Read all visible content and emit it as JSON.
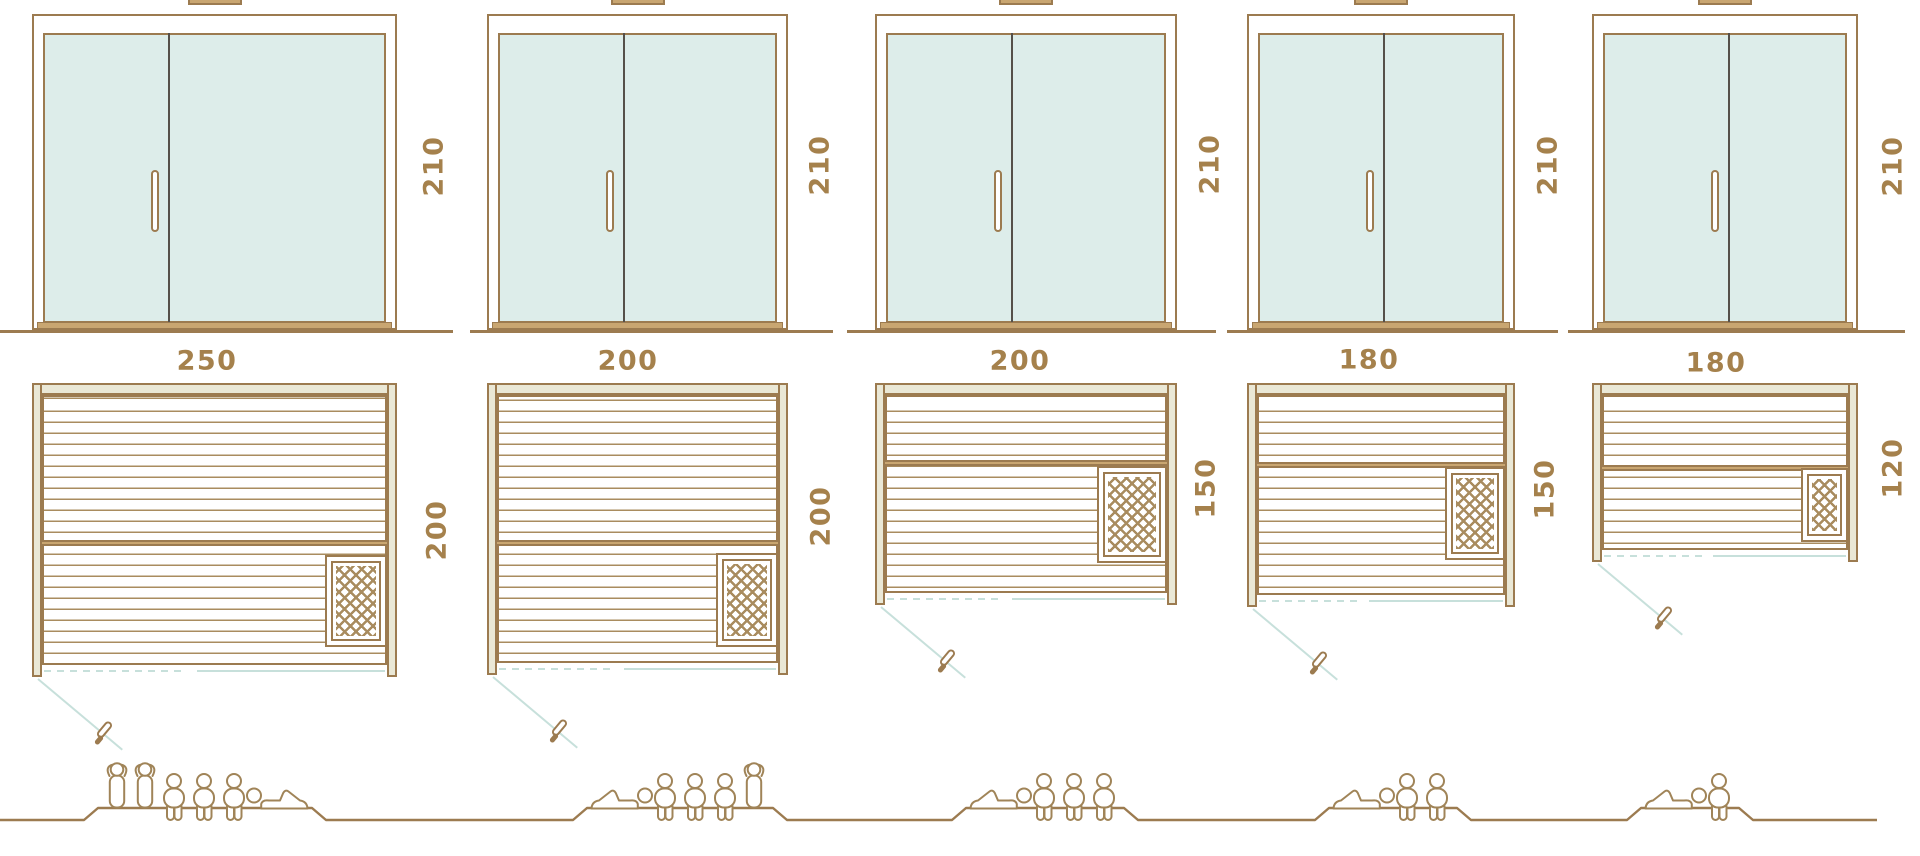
{
  "diagram_title": "sauna-cabin-size-comparison",
  "palette": {
    "background": "#ffffff",
    "outline_brown": "#9c7b50",
    "hatch_brown": "#a98c5f",
    "label_brown": "#a5814c",
    "glass_fill": "#ddedea",
    "wall_fill": "#eae8d6",
    "wood_tan": "#c9a671",
    "divider_dark": "#55504a",
    "swing_cyan": "#c7e0db",
    "figure_brown": "#a08458"
  },
  "units": [
    {
      "id": "sauna-250x200",
      "door": {
        "width_label": "250",
        "height_label": "210"
      },
      "plan": {
        "depth_label": "200"
      },
      "dimensions_cm": {
        "width": 250,
        "depth": 200,
        "height": 210
      },
      "capacity": {
        "total": 6,
        "figures": [
          "standing",
          "standing",
          "sitting",
          "sitting",
          "sitting",
          "lying-mirrored"
        ]
      }
    },
    {
      "id": "sauna-200x200",
      "door": {
        "width_label": "200",
        "height_label": "210"
      },
      "plan": {
        "depth_label": "200"
      },
      "dimensions_cm": {
        "width": 200,
        "depth": 200,
        "height": 210
      },
      "capacity": {
        "total": 5,
        "figures": [
          "lying",
          "sitting",
          "sitting",
          "sitting",
          "standing"
        ]
      }
    },
    {
      "id": "sauna-200x150",
      "door": {
        "width_label": "200",
        "height_label": "210"
      },
      "plan": {
        "depth_label": "150"
      },
      "dimensions_cm": {
        "width": 200,
        "depth": 150,
        "height": 210
      },
      "capacity": {
        "total": 4,
        "figures": [
          "lying",
          "sitting",
          "sitting",
          "sitting"
        ]
      }
    },
    {
      "id": "sauna-180x150",
      "door": {
        "width_label": "180",
        "height_label": "210"
      },
      "plan": {
        "depth_label": "150"
      },
      "dimensions_cm": {
        "width": 180,
        "depth": 150,
        "height": 210
      },
      "capacity": {
        "total": 3,
        "figures": [
          "lying",
          "sitting",
          "sitting"
        ]
      }
    },
    {
      "id": "sauna-180x120",
      "door": {
        "width_label": "180",
        "height_label": "210"
      },
      "plan": {
        "depth_label": "120"
      },
      "dimensions_cm": {
        "width": 180,
        "depth": 120,
        "height": 210
      },
      "capacity": {
        "total": 2,
        "figures": [
          "lying",
          "sitting"
        ]
      }
    }
  ]
}
